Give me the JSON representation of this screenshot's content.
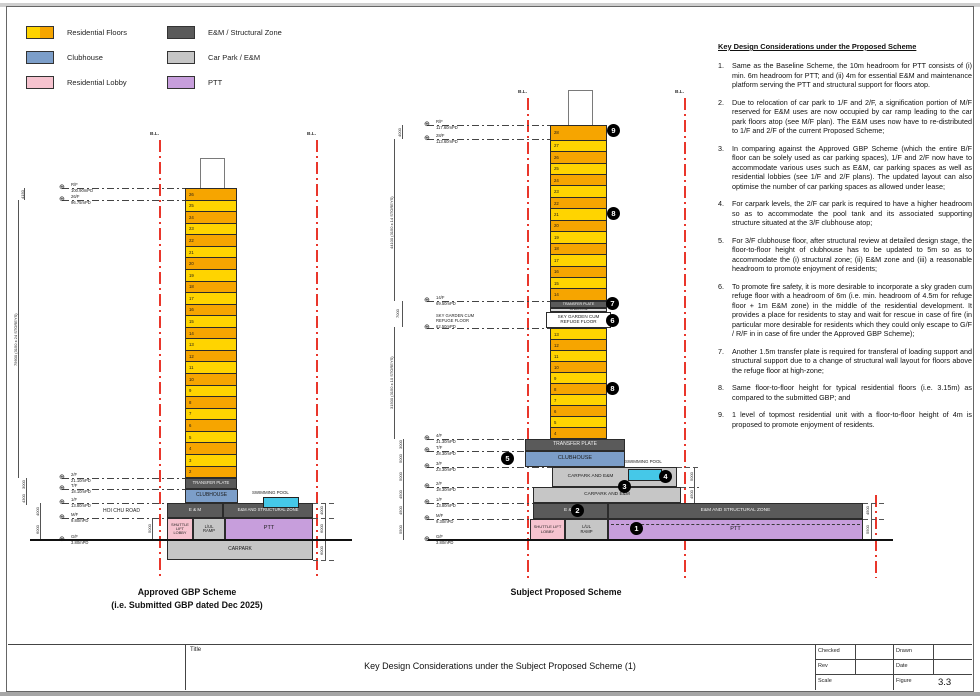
{
  "legend": {
    "items": [
      {
        "label": "Residential Floors",
        "swatch": "residential"
      },
      {
        "label": "Clubhouse",
        "swatch": "clubhouse"
      },
      {
        "label": "Residential Lobby",
        "swatch": "lobby"
      },
      {
        "label": "E&M / Structural Zone",
        "swatch": "em"
      },
      {
        "label": "Car Park / E&M",
        "swatch": "carpark"
      },
      {
        "label": "PTT",
        "swatch": "ptt"
      }
    ]
  },
  "colors": {
    "residential_orange": "#F6A500",
    "residential_yellow": "#FFD400",
    "clubhouse_blue": "#7C9EC9",
    "lobby_pink": "#F6C3CF",
    "em_gray": "#5A5A5A",
    "carpark_gray": "#C6C6C6",
    "ptt_purple": "#C79EDC",
    "pool_cyan": "#45C8E8",
    "boundary_red": "#E9362B"
  },
  "left_scheme": {
    "bl_label": "B.L.",
    "title1": "Approved GBP Scheme",
    "title2": "(i.e. Submitted GBP dated Dec 2025)",
    "floors": [
      {
        "n": "26",
        "shade": "orange"
      },
      {
        "n": "25",
        "shade": "yellow"
      },
      {
        "n": "24",
        "shade": "orange"
      },
      {
        "n": "23",
        "shade": "yellow"
      },
      {
        "n": "22",
        "shade": "orange"
      },
      {
        "n": "21",
        "shade": "yellow"
      },
      {
        "n": "20",
        "shade": "orange"
      },
      {
        "n": "19",
        "shade": "yellow"
      },
      {
        "n": "18",
        "shade": "orange"
      },
      {
        "n": "17",
        "shade": "yellow"
      },
      {
        "n": "16",
        "shade": "orange"
      },
      {
        "n": "15",
        "shade": "yellow"
      },
      {
        "n": "14",
        "shade": "orange"
      },
      {
        "n": "13",
        "shade": "yellow"
      },
      {
        "n": "12",
        "shade": "orange"
      },
      {
        "n": "11",
        "shade": "yellow"
      },
      {
        "n": "10",
        "shade": "orange"
      },
      {
        "n": "9",
        "shade": "yellow"
      },
      {
        "n": "8",
        "shade": "orange"
      },
      {
        "n": "7",
        "shade": "yellow"
      },
      {
        "n": "6",
        "shade": "orange"
      },
      {
        "n": "5",
        "shade": "yellow"
      },
      {
        "n": "4",
        "shade": "orange"
      },
      {
        "n": "3",
        "shade": "yellow"
      },
      {
        "n": "2",
        "shade": "orange"
      }
    ],
    "labels": {
      "transfer": "TRANSFER PLATE",
      "clubhouse": "CLUBHOUSE",
      "em": "E & M",
      "em_struct": "E&M AND STRUCTURAL ZONE",
      "pool": "SWIMMING POOL",
      "shuttle": "SHUTTLE LIFT\nLOBBY",
      "ramp": "L/UL\nRAMP",
      "ptt": "PTT",
      "carpark": "CARPARK",
      "road": "HOI CHU ROAD"
    },
    "markers": [
      {
        "label": "R/F",
        "elev": "100.90mPD"
      },
      {
        "label": "26/F",
        "elev": "96.75mPD"
      },
      {
        "label": "2/F",
        "elev": "21.10mPD"
      },
      {
        "label": "T/F",
        "elev": "18.10mPD"
      },
      {
        "label": "1/F",
        "elev": "13.80mPD"
      },
      {
        "label": "M/F",
        "elev": "9.80mPD"
      },
      {
        "label": "G/F",
        "elev": "3.80mPD"
      }
    ],
    "dims": {
      "top": "4150",
      "tower": "75600 (3150 x 24 STOREYS)",
      "b1": "3000",
      "b2": "4300",
      "b3": "4000",
      "b4": "6000",
      "road": "5000",
      "r1": "4000",
      "r2": "6000",
      "r3": "6000"
    }
  },
  "right_scheme": {
    "bl_label": "B.L.",
    "title": "Subject Proposed Scheme",
    "floors_high": [
      {
        "n": "28",
        "shade": "orange",
        "size": "tall"
      },
      {
        "n": "27",
        "shade": "yellow"
      },
      {
        "n": "26",
        "shade": "orange"
      },
      {
        "n": "25",
        "shade": "yellow"
      },
      {
        "n": "24",
        "shade": "orange"
      },
      {
        "n": "23",
        "shade": "yellow"
      },
      {
        "n": "22",
        "shade": "orange"
      },
      {
        "n": "21",
        "shade": "yellow"
      },
      {
        "n": "20",
        "shade": "orange"
      },
      {
        "n": "19",
        "shade": "yellow"
      },
      {
        "n": "18",
        "shade": "orange"
      },
      {
        "n": "17",
        "shade": "yellow"
      },
      {
        "n": "16",
        "shade": "orange"
      },
      {
        "n": "15",
        "shade": "yellow"
      },
      {
        "n": "14",
        "shade": "orange"
      }
    ],
    "floors_low": [
      {
        "n": "13",
        "shade": "yellow"
      },
      {
        "n": "12",
        "shade": "orange"
      },
      {
        "n": "11",
        "shade": "yellow"
      },
      {
        "n": "10",
        "shade": "orange"
      },
      {
        "n": "9",
        "shade": "yellow"
      },
      {
        "n": "8",
        "shade": "orange"
      },
      {
        "n": "7",
        "shade": "yellow"
      },
      {
        "n": "6",
        "shade": "orange"
      },
      {
        "n": "5",
        "shade": "yellow"
      },
      {
        "n": "4",
        "shade": "orange"
      }
    ],
    "labels": {
      "transfer_mid": "TRANSFER PLATE",
      "em_strip": "1M E&M ZONE",
      "sky_garden": "SKY GARDEN CUM\nREFUGE FLOOR",
      "transfer": "TRANSFER PLATE",
      "clubhouse": "CLUBHOUSE",
      "carpark_upper": "CARPARK AND E&M",
      "carpark_lower": "CARPARK AND E&M",
      "em": "E & M",
      "em_struct": "E&M AND STRUCTURAL ZONE",
      "pool": "SWIMMING POOL",
      "shuttle": "SHUTTLE LIFT\nLOBBY",
      "ramp": "L/UL\nRAMP",
      "ptt": "PTT"
    },
    "markers": [
      {
        "label": "R/F",
        "elev": "117.60mPD"
      },
      {
        "label": "28/F",
        "elev": "113.60mPD"
      },
      {
        "label": "14/F",
        "elev": "69.50mPD"
      },
      {
        "label": "SKY GARDEN CUM\nREFUGE FLOOR",
        "elev": "62.50mPD"
      },
      {
        "label": "4/F",
        "elev": "31.30mPD"
      },
      {
        "label": "T/F",
        "elev": "28.30mPD"
      },
      {
        "label": "3/F",
        "elev": "23.30mPD"
      },
      {
        "label": "2/F",
        "elev": "18.30mPD"
      },
      {
        "label": "1/F",
        "elev": "13.80mPD"
      },
      {
        "label": "M/F",
        "elev": "9.30mPD"
      },
      {
        "label": "G/F",
        "elev": "3.80mPD"
      }
    ],
    "dims": {
      "top": "4000",
      "upper": "44100 (3150 x 14 STOREYS)",
      "mid": "7000",
      "lower": "31500 (3150 x 10 STOREYS)",
      "b1": "3000",
      "b2": "5000",
      "b3": "5000",
      "b4": "4500",
      "b5": "4500",
      "b6": "5500",
      "r1": "5000",
      "r2": "4500",
      "far1": "4500",
      "far2": "5500"
    },
    "callouts": {
      "c1": "1",
      "c2": "2",
      "c3": "3",
      "c4": "4",
      "c5": "5",
      "c6": "6",
      "c7": "7",
      "c8_upper": "8",
      "c8_lower": "8",
      "c9": "9"
    }
  },
  "notes": {
    "heading": "Key Design Considerations under the Proposed Scheme",
    "items": [
      {
        "n": "1.",
        "text": "Same as the Baseline Scheme, the 10m headroom for PTT consists of (i) min. 6m headroom for PTT; and (ii) 4m for essential E&M and maintenance platform serving the PTT and structural support for floors atop."
      },
      {
        "n": "2.",
        "text": "Due to relocation of car park to 1/F and 2/F, a signification portion of M/F reserved for E&M uses are now occupied by car ramp leading to the car park floors atop (see M/F plan). The E&M uses now have to re-distributed to 1/F and 2/F of the current Proposed Scheme;"
      },
      {
        "n": "3.",
        "text": "In comparing against the Approved GBP Scheme (which the entire B/F floor can be solely used as car parking spaces), 1/F and 2/F now have to accommodate various uses such as E&M, car parking spaces as well as residential lobbies (see 1/F and 2/F plans). The updated layout can also optimise the number of car parking spaces as allowed under lease;"
      },
      {
        "n": "4.",
        "text": "For carpark levels, the 2/F car park is required to have a higher headroom so as to accommodate the pool tank and its associated supporting structure situated at the 3/F clubhouse atop;"
      },
      {
        "n": "5.",
        "text": "For 3/F clubhouse floor, after structural review at detailed design stage, the floor-to-floor height of clubhouse has to be updated to 5m so as to accommodate the (i) structural zone; (ii) E&M zone and (iii) a reasonable headroom to promote enjoyment of residents;"
      },
      {
        "n": "6.",
        "text": "To promote fire safety, it is more desirable to incorporate a sky graden cum refuge floor with a headroom of 6m (i.e. min. headroom of 4.5m for refuge floor + 1m E&M zone) in the middle of the residential development. It provides a place for residents to stay and wait for rescue in case of fire (in particular more desirable for residents which they could only escape to G/F / R/F in in case of fire under the Approved GBP Scheme);"
      },
      {
        "n": "7.",
        "text": "Another 1.5m transfer plate is required for transferal of loading support and structural support due to a change of structural wall layout for floors above the refuge floor at high-zone;"
      },
      {
        "n": "8.",
        "text": "Same floor-to-floor height for typical residential floors (i.e. 3.15m) as compared to the submitted GBP; and"
      },
      {
        "n": "9.",
        "text": "1 level of topmost residential unit with a floor-to-floor height of 4m is proposed to promote enjoyment of residents."
      }
    ]
  },
  "title_block": {
    "title_label": "Title",
    "main_title": "Key Design Considerations under the Subject Proposed Scheme (1)",
    "checked_label": "Checked",
    "drawn_label": "Drawn",
    "rev_label": "Rev",
    "date_label": "Date",
    "scale_label": "Scale",
    "figure_label": "Figure",
    "figure_number": "3.3"
  }
}
